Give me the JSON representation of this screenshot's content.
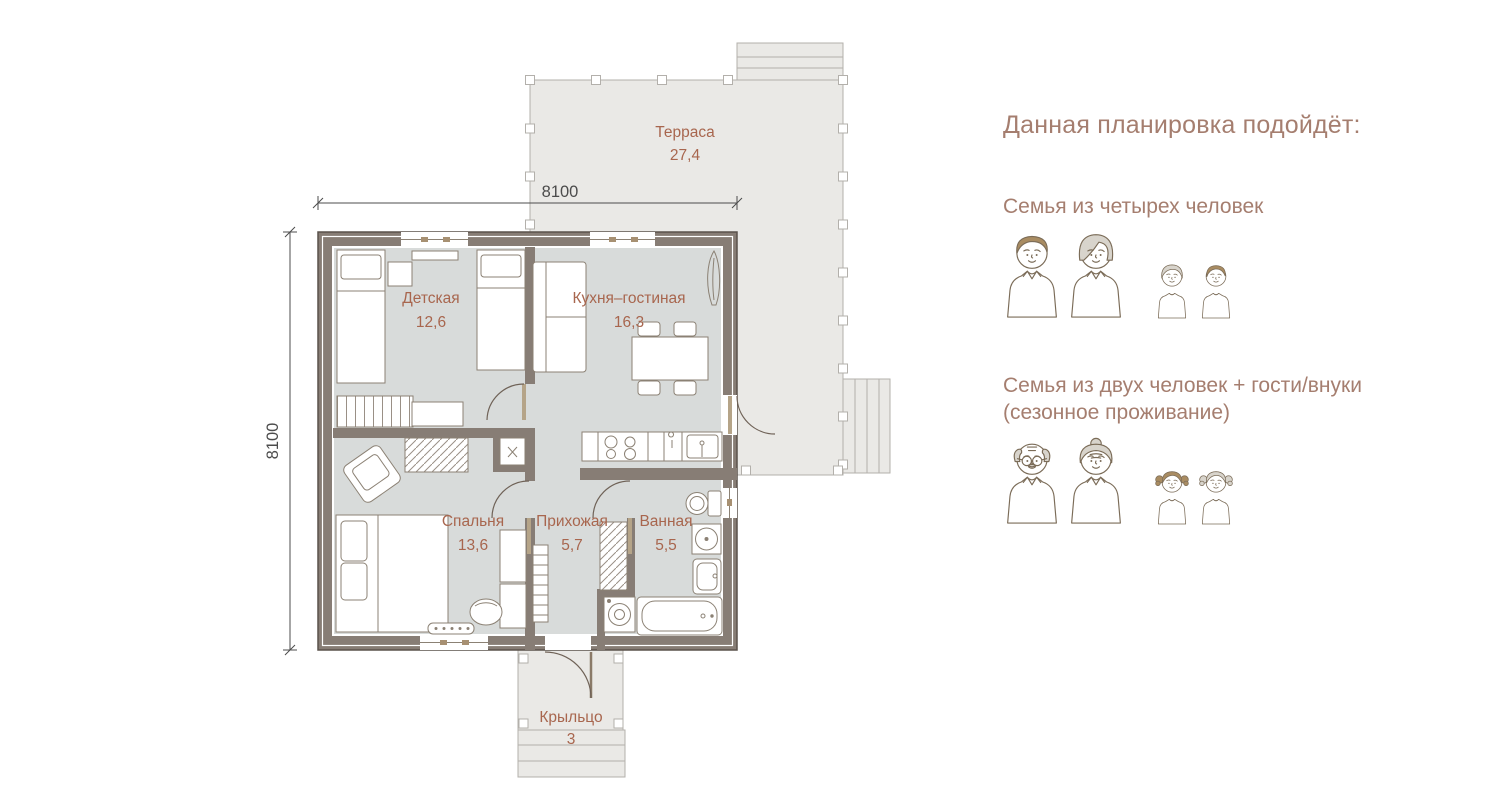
{
  "plan": {
    "rooms": {
      "terrace": {
        "label": "Терраса",
        "area": "27,4"
      },
      "kids": {
        "label": "Детская",
        "area": "12,6"
      },
      "kitchen": {
        "label": "Кухня–гостиная",
        "area": "16,3"
      },
      "bedroom": {
        "label": "Спальня",
        "area": "13,6"
      },
      "hallway": {
        "label": "Прихожая",
        "area": "5,7"
      },
      "bathroom": {
        "label": "Ванная",
        "area": "5,5"
      },
      "porch": {
        "label": "Крыльцо",
        "area": "3"
      }
    },
    "dim_top": "8100",
    "dim_left": "8100"
  },
  "panel": {
    "heading": "Данная планировка подойдёт:",
    "options": [
      {
        "title": "Семья из четырех человек",
        "subtitle": "",
        "groups": [
          [
            "man",
            "woman"
          ],
          [
            "girl-short",
            "boy"
          ]
        ]
      },
      {
        "title": "Семья из двух человек + гости/внуки",
        "subtitle": "(сезонное проживание)",
        "groups": [
          [
            "grandpa",
            "grandma"
          ],
          [
            "girl-pigtails-dark",
            "girl-pigtails-light"
          ]
        ]
      }
    ]
  },
  "colors": {
    "room_label": "#a8664e",
    "panel_text": "#a57e6f",
    "wall": "#877d75",
    "floor": "#d8dbda",
    "terrace_fill": "#eae9e6",
    "terrace_stroke": "#b3b0ab",
    "dimension": "#4c4c4c",
    "icon_stroke": "#7b6c58",
    "icon_hair_brown": "#a98c62",
    "icon_hair_gray": "#d8d4cc",
    "door_leaf": "#b5a488"
  }
}
